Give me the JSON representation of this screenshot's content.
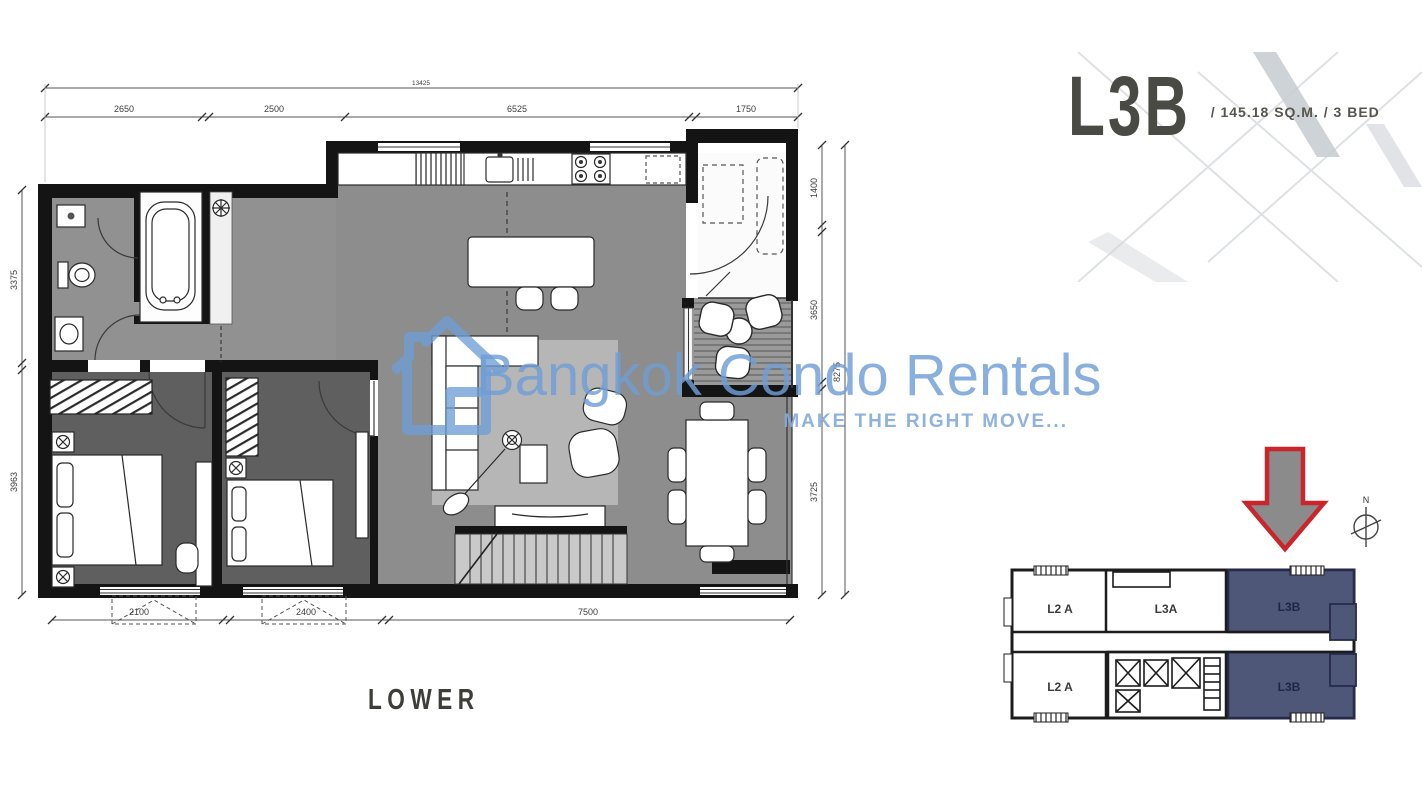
{
  "title_block": {
    "unit": "L3B",
    "details": "/ 145.18 SQ.M. / 3 BED"
  },
  "watermark": {
    "brand": "Bangkok Condo Rentals",
    "tagline": "MAKE THE RIGHT MOVE...",
    "color": "#6f9ed6"
  },
  "floor_plan": {
    "level_label": "LOWER",
    "dimensions": {
      "top_total": "13425",
      "top": [
        "2650",
        "2500",
        "6525",
        "1750"
      ],
      "left": [
        "3375",
        "3963"
      ],
      "right": [
        "1400",
        "3650",
        "3725"
      ],
      "right_total": "8275",
      "bottom": [
        "2100",
        "2400",
        "7500"
      ]
    }
  },
  "key_plan": {
    "highlight_color": "#4f5779",
    "arrow_color": "#c9252b",
    "compass_label": "N",
    "units": {
      "top_left": "L2 A",
      "top_middle": "L3A",
      "top_right": "L3B",
      "bottom_left": "L2 A",
      "bottom_right": "L3B"
    }
  }
}
